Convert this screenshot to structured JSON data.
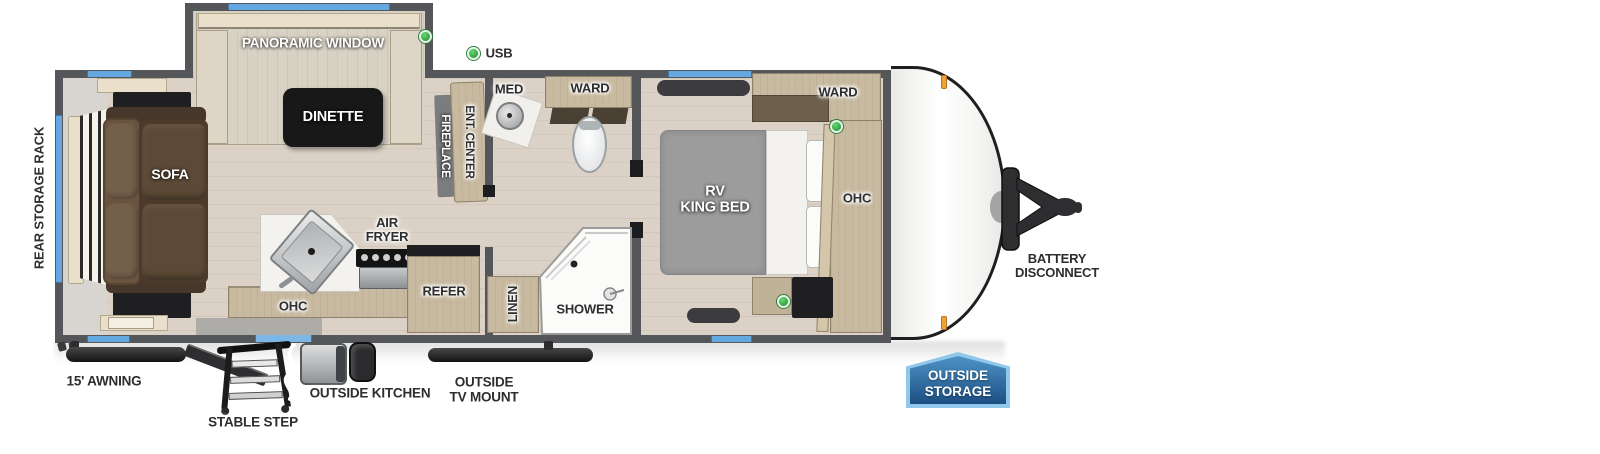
{
  "labels": {
    "rear_storage_rack": "REAR STORAGE RACK",
    "sofa": "SOFA",
    "panoramic_window": "PANORAMIC WINDOW",
    "dinette": "DINETTE",
    "usb": "USB",
    "fireplace": "FIREPLACE",
    "ent_center": "ENT. CENTER",
    "med": "MED",
    "ward_bath": "WARD",
    "ward_bedroom": "WARD",
    "rv_bed_1": "RV",
    "rv_bed_2": "KING BED",
    "ohc_kitchen": "OHC",
    "ohc_bedroom": "OHC",
    "air_fryer_1": "AIR",
    "air_fryer_2": "FRYER",
    "refer": "REFER",
    "linen": "LINEN",
    "shower": "SHOWER",
    "battery_1": "BATTERY",
    "battery_2": "DISCONNECT",
    "outside_storage_1": "OUTSIDE",
    "outside_storage_2": "STORAGE",
    "awning": "15' AWNING",
    "stable_step": "STABLE STEP",
    "outside_kitchen": "OUTSIDE KITCHEN",
    "tv_mount_1": "OUTSIDE",
    "tv_mount_2": "TV MOUNT"
  },
  "colors": {
    "wall": "#55565a",
    "window_blue": "#64a8e2",
    "usb_green": "#3cb54a",
    "badge_blue": "#2e6da4",
    "badge_border": "#8fc8ea",
    "marker_orange": "#f0a23a",
    "floor_wood": "#dbd1c6",
    "cabinet_tan": "#c8baa0",
    "sofa_brown": "#57452f",
    "bed_gray": "#9c9c9c"
  }
}
